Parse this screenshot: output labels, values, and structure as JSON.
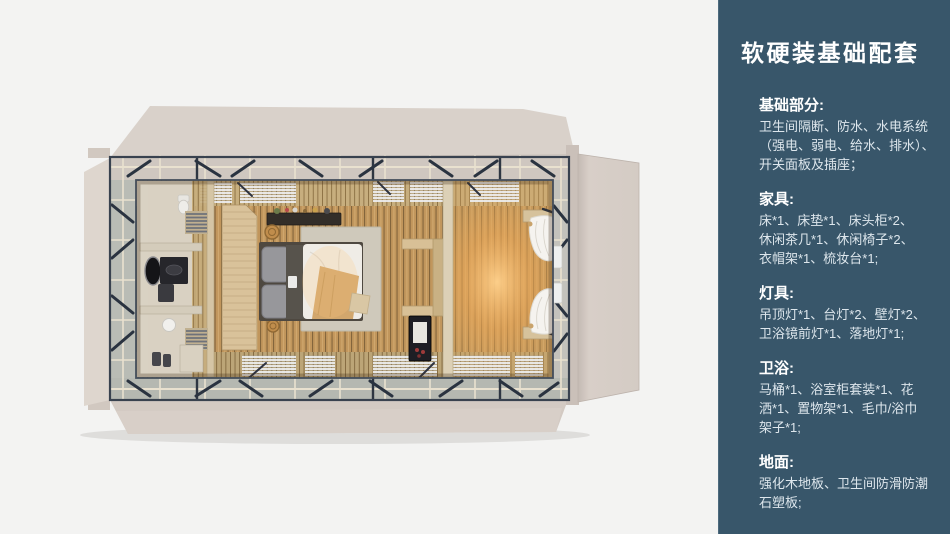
{
  "page": {
    "background": "#f3f3f2"
  },
  "sidebar": {
    "background": "#38566a",
    "text_color": "#ffffff",
    "body_text_color": "#dde6ec",
    "title": "软硬装基础配套",
    "sections": [
      {
        "heading": "基础部分:",
        "body": "卫生间隔断、防水、水电系统\n（强电、弱电、给水、排水）、\n开关面板及插座；"
      },
      {
        "heading": "家具:",
        "body": "床*1、床垫*1、床头柜*2、\n休闲茶几*1、休闲椅子*2、\n衣帽架*1、梳妆台*1;"
      },
      {
        "heading": "灯具:",
        "body": "吊顶灯*1、台灯*2、壁灯*2、\n卫浴镜前灯*1、落地灯*1;"
      },
      {
        "heading": "卫浴:",
        "body": "马桶*1、浴室柜套装*1、花\n洒*1、置物架*1、毛巾/浴巾\n架子*1;"
      },
      {
        "heading": "地面:",
        "body": "强化木地板、卫生间防滑防潮\n石塑板;"
      }
    ]
  },
  "floorplan": {
    "type": "top-down-room-render",
    "colors": {
      "shell": "#d8cfc8",
      "frame_dark": "#2e3642",
      "frame_rail": "#e9e1cf",
      "floor_wood": "#c1965c",
      "glow": "#f2a855",
      "bathroom_floor": "#d9d1c2",
      "wardrobe_panel": "#d9c29a",
      "duvet": "#efece6",
      "curtain": "#f5f3ef",
      "minibar": "#1e1e24"
    }
  }
}
